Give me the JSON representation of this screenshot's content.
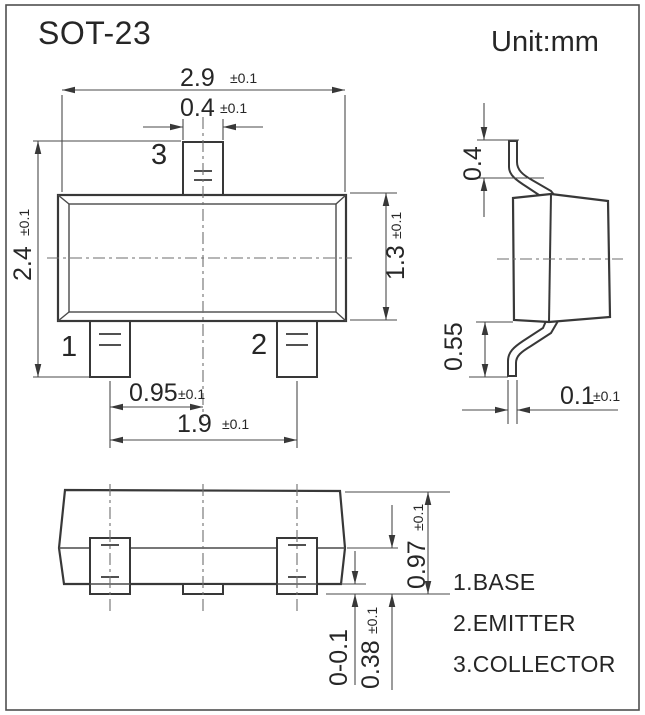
{
  "header": {
    "title": "SOT-23",
    "unit_label": "Unit:mm"
  },
  "top_view": {
    "pin1_label": "1",
    "pin2_label": "2",
    "pin3_label": "3",
    "dims": {
      "overall_width": {
        "value": "2.9",
        "tolerance": "±0.1"
      },
      "pin_width": {
        "value": "0.4",
        "tolerance": "±0.1"
      },
      "overall_height": {
        "value": "2.4",
        "tolerance": "±0.1"
      },
      "body_depth": {
        "value": "1.3",
        "tolerance": "±0.1"
      },
      "pin_pitch": {
        "value": "0.95",
        "tolerance": "±0.1"
      },
      "pin_span": {
        "value": "1.9",
        "tolerance": "±0.1"
      }
    }
  },
  "side_view": {
    "dims": {
      "lead_top_height": {
        "value": "0.4"
      },
      "lead_bottom_height": {
        "value": "0.55"
      },
      "lead_thickness": {
        "value": "0.1",
        "tolerance": "±0.1"
      }
    }
  },
  "front_view": {
    "dims": {
      "body_height": {
        "value": "0.97",
        "tolerance": "±0.1"
      },
      "lead_foot_height": {
        "value": "0.38",
        "tolerance": "±0.1"
      },
      "standoff": {
        "value": "0-0.1"
      }
    }
  },
  "legend": {
    "items": [
      {
        "label": "1.BASE"
      },
      {
        "label": "2.EMITTER"
      },
      {
        "label": "3.COLLECTOR"
      }
    ]
  },
  "colors": {
    "background": "#ffffff",
    "line": "#383838",
    "dim_line": "#4a4a4a",
    "text": "#262626",
    "frame": "#4f4f4f"
  }
}
